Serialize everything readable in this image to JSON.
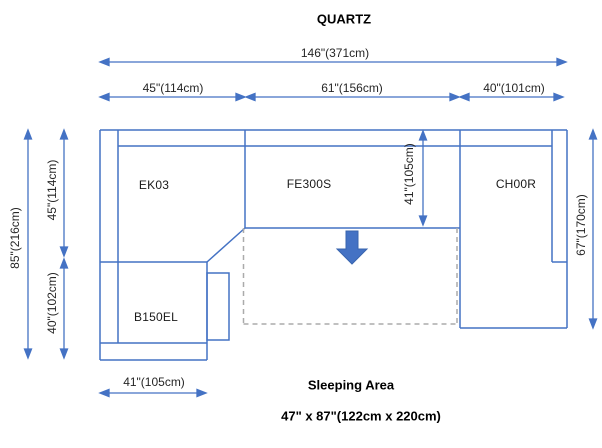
{
  "title": "QUARTZ",
  "diagram": {
    "components": {
      "ek03": "EK03",
      "fe300s": "FE300S",
      "ch00r": "CH00R",
      "b150el": "B150EL"
    },
    "dimensions": {
      "total_width": "146\"(371cm)",
      "ek03_width": "45\"(114cm)",
      "fe300s_width": "61\"(156cm)",
      "ch00r_width": "40\"(101cm)",
      "total_depth": "85\"(216cm)",
      "left_upper_depth": "45\"(114cm)",
      "left_lower_depth": "40\"(102cm)",
      "ch00r_depth": "67\"(170cm)",
      "fe300s_depth": "41\"(105cm)",
      "b150el_width": "41\"(105cm)"
    },
    "sleeping_area": {
      "label": "Sleeping Area",
      "size": "47\" x 87\"(122cm x 220cm)"
    },
    "colors": {
      "line": "#4472C4",
      "dashed_line": "#ABABAB",
      "arrow_fill": "#4472C4",
      "text": "#262626"
    }
  }
}
